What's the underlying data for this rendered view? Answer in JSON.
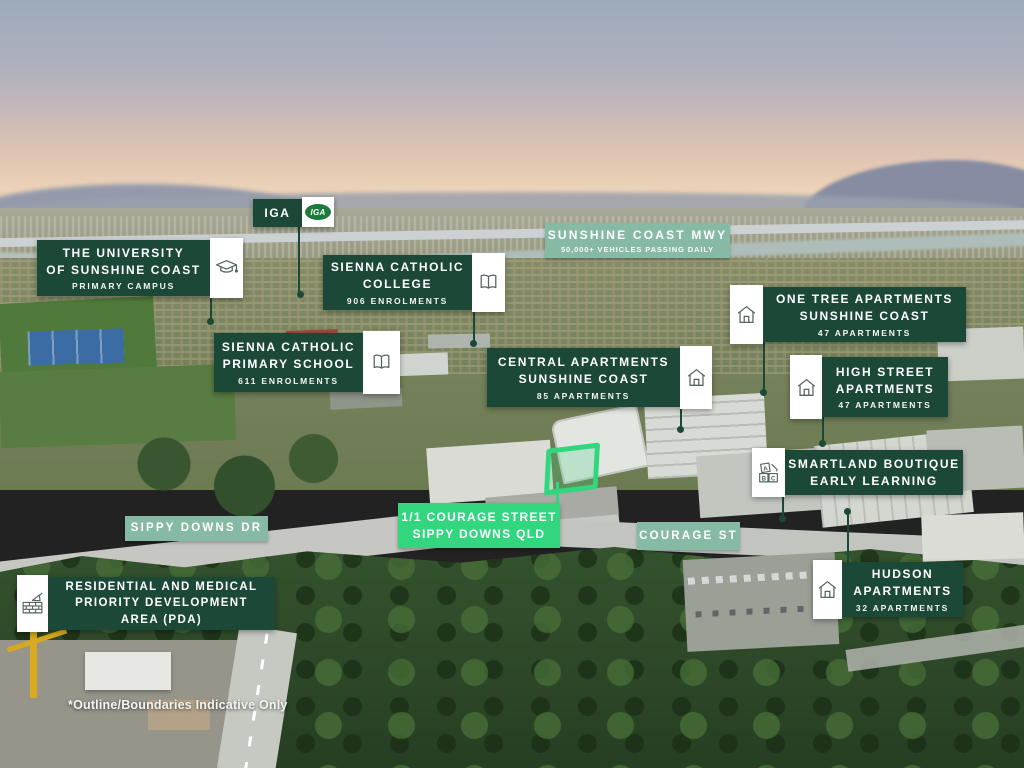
{
  "colors": {
    "dark_green": "#1c4838",
    "sage_green": "#87baa4",
    "bright_green": "#31d67e",
    "label_text": "#ffffff"
  },
  "callouts": {
    "iga": {
      "title": "IGA",
      "logo_text": "IGA"
    },
    "university": {
      "line1": "THE UNIVERSITY",
      "line2": "OF SUNSHINE COAST",
      "subtitle": "PRIMARY CAMPUS"
    },
    "sienna_college": {
      "line1": "SIENNA CATHOLIC",
      "line2": "COLLEGE",
      "subtitle": "906 ENROLMENTS"
    },
    "sienna_primary": {
      "line1": "SIENNA CATHOLIC",
      "line2": "PRIMARY SCHOOL",
      "subtitle": "611 ENROLMENTS"
    },
    "central": {
      "line1": "CENTRAL APARTMENTS",
      "line2": "SUNSHINE COAST",
      "subtitle": "85 APARTMENTS"
    },
    "one_tree": {
      "line1": "ONE TREE APARTMENTS",
      "line2": "SUNSHINE COAST",
      "subtitle": "47 APARTMENTS"
    },
    "high_street": {
      "line1": "HIGH STREET",
      "line2": "APARTMENTS",
      "subtitle": "47 APARTMENTS"
    },
    "smartland": {
      "line1": "SMARTLAND BOUTIQUE",
      "line2": "EARLY LEARNING"
    },
    "hudson": {
      "line1": "HUDSON",
      "line2": "APARTMENTS",
      "subtitle": "32 APARTMENTS"
    },
    "pda": {
      "line1": "RESIDENTIAL AND MEDICAL",
      "line2": "PRIORITY DEVELOPMENT",
      "line3": "AREA (PDA)"
    }
  },
  "roads": {
    "mwy": {
      "title": "SUNSHINE COAST MWY",
      "subtitle": "50,000+ VEHICLES PASSING DAILY"
    },
    "sippy_downs": {
      "title": "SIPPY DOWNS DR"
    },
    "courage": {
      "title": "COURAGE ST"
    }
  },
  "property": {
    "line1": "1/1 COURAGE STREET",
    "line2": "SIPPY DOWNS QLD"
  },
  "disclaimer": "*Outline/Boundaries Indicative Only",
  "icons": {
    "abc_letters": {
      "a": "A",
      "b": "B",
      "c": "C"
    }
  }
}
